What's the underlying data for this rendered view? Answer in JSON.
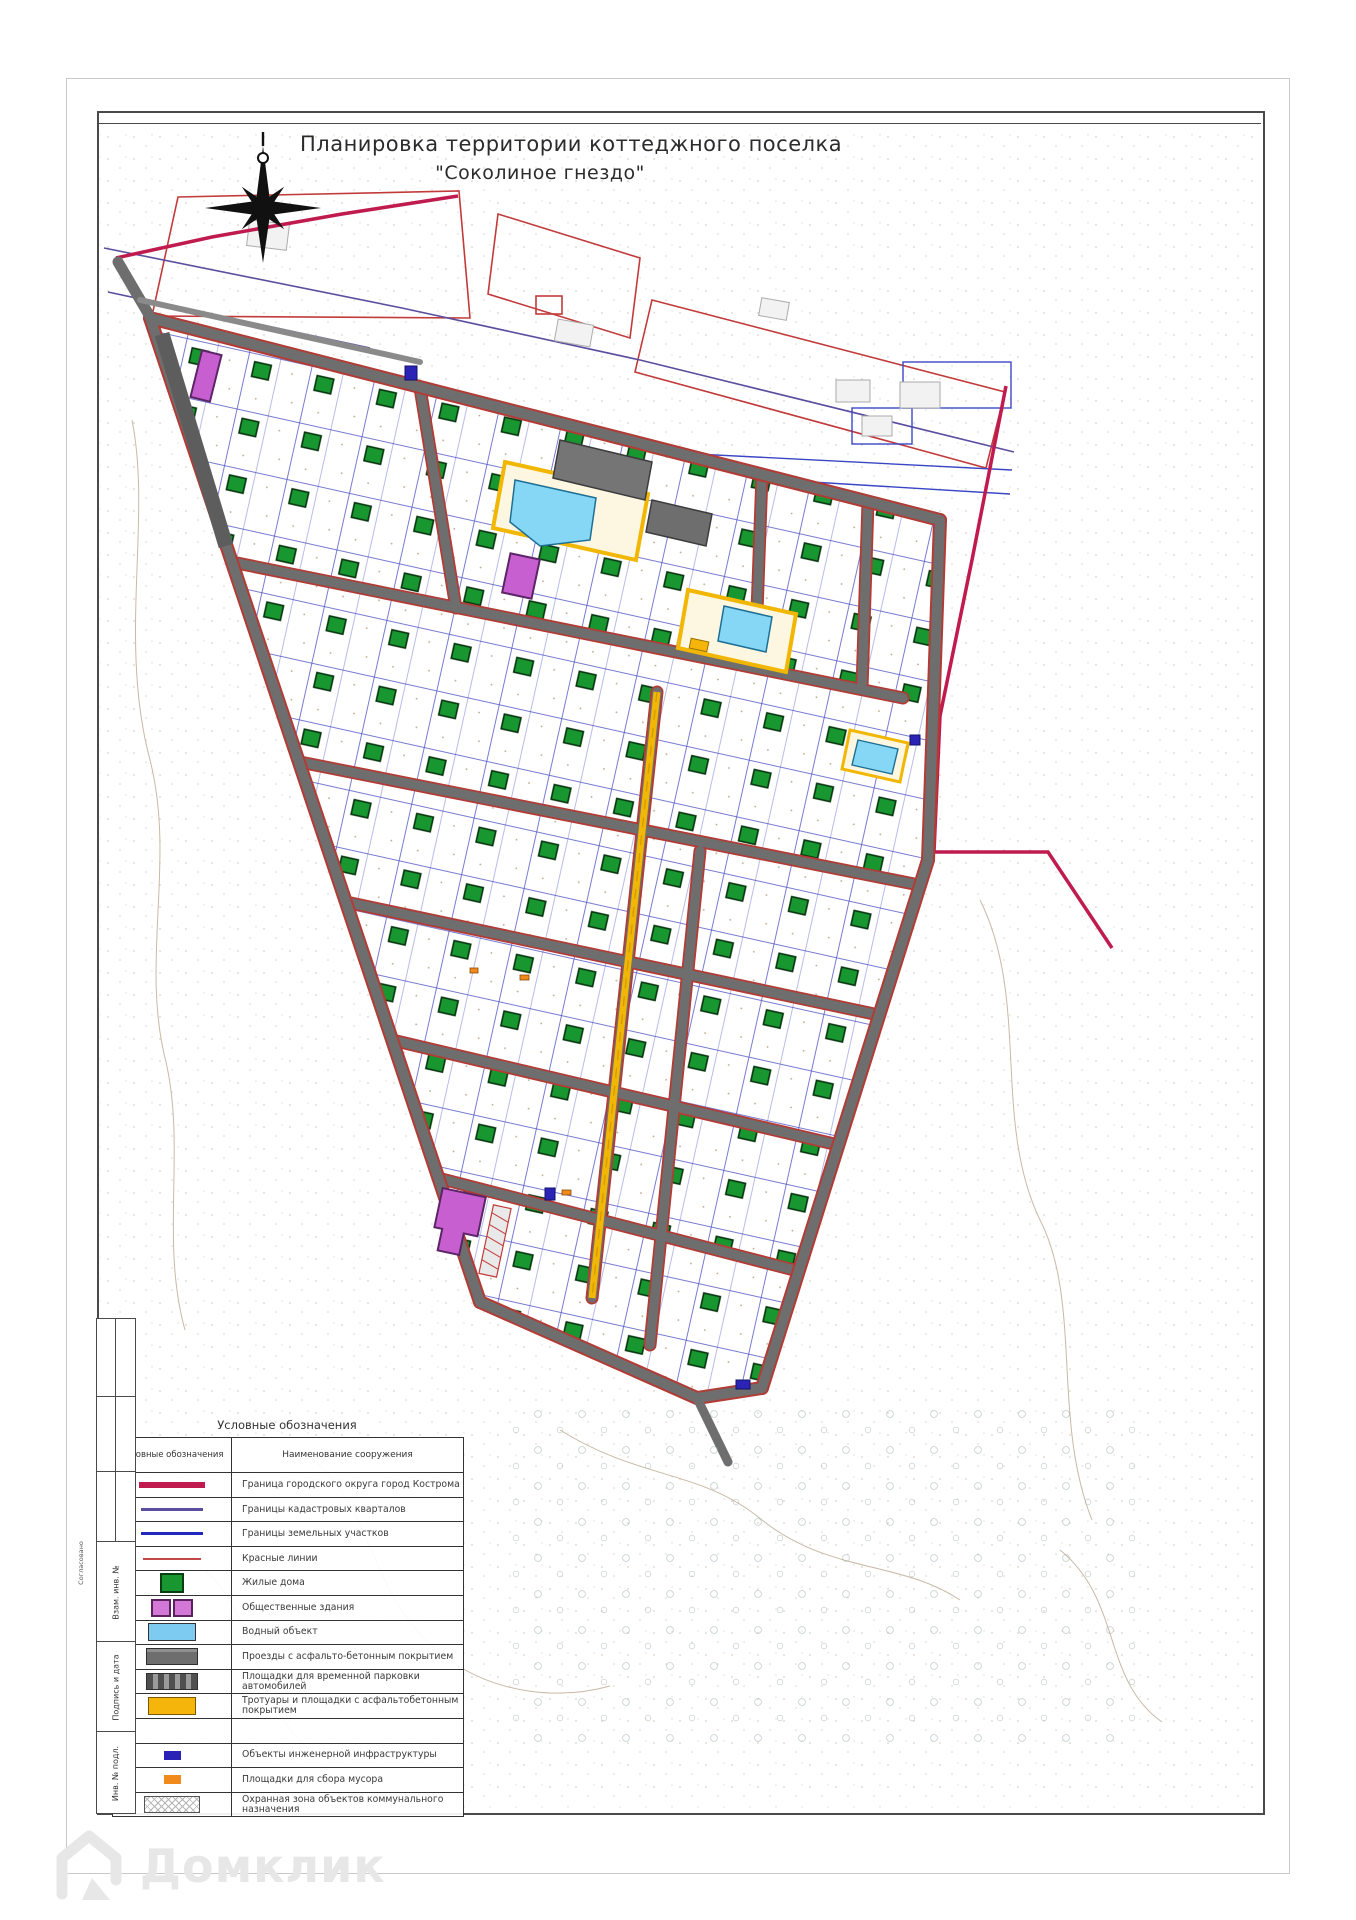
{
  "page": {
    "title_line1": "Планировка территории коттеджного поселка",
    "title_line2": "\"Соколиное гнездо\""
  },
  "legend": {
    "title": "Условные обозначения",
    "col_symbol": "Условные обозначения",
    "col_name": "Наименование сооружения",
    "items": [
      {
        "symbol": "line-crimson",
        "label": "Граница городского округа город Кострома"
      },
      {
        "symbol": "line-purple",
        "label": "Границы кадастровых кварталов"
      },
      {
        "symbol": "line-blue",
        "label": "Границы земельных участков"
      },
      {
        "symbol": "line-red",
        "label": "Красные линии"
      },
      {
        "symbol": "sw-green",
        "label": "Жилые дома"
      },
      {
        "symbol": "sw-magenta",
        "label": "Общественные здания"
      },
      {
        "symbol": "sw-water",
        "label": "Водный объект"
      },
      {
        "symbol": "sw-road",
        "label": "Проезды с асфальто-бетонным покрытием"
      },
      {
        "symbol": "sw-parking",
        "label": "Площадки для временной парковки автомобилей"
      },
      {
        "symbol": "sw-walk",
        "label": "Тротуары и площадки с асфальтобетонным покрытием"
      },
      {
        "symbol": "empty",
        "label": ""
      },
      {
        "symbol": "chip-infra",
        "label": "Объекты инженерной инфраструктуры"
      },
      {
        "symbol": "chip-trash",
        "label": "Площадки для сбора мусора"
      },
      {
        "symbol": "sw-guard",
        "label": "Охранная зона объектов коммунального назначения"
      }
    ]
  },
  "titleblock": {
    "approved": "Согласовано",
    "labels": [
      "Взам. инв. №",
      "Подпись и дата",
      "Инв. № подл."
    ]
  },
  "watermark": {
    "text": "Домклик"
  },
  "colors": {
    "district_boundary": "#c01b4e",
    "cadastral_boundary": "#5b4ea0",
    "parcel_boundary": "#2227bd",
    "red_line": "#c34a4a",
    "house_green": "#18962f",
    "public_building": "#d478d8",
    "water": "#7ecbf2",
    "road": "#6e6e6e",
    "walkway_yellow": "#f5b50a",
    "infrastructure": "#2a23b5",
    "trash": "#f08a1d"
  }
}
